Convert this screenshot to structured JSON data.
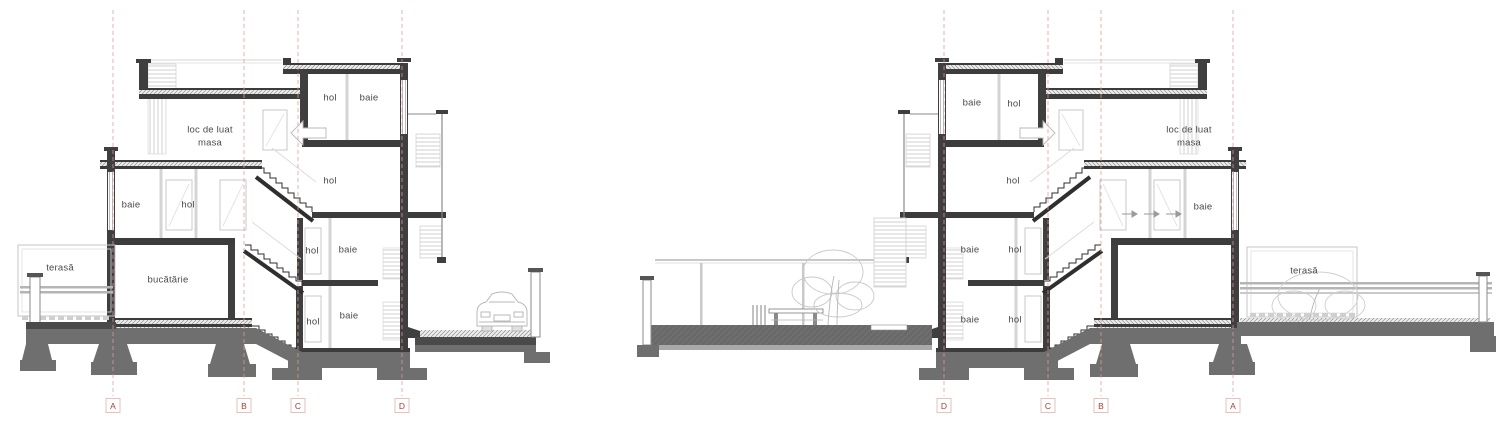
{
  "drawing": {
    "background": "#ffffff",
    "colors": {
      "wall_dark": "#3f3f3f",
      "foundation_gray": "#6f6f6f",
      "light_gray_line": "#c9c9c9",
      "label_text": "#4a4a4a",
      "grid_marker_red": "#b03a2e",
      "grid_line_red": "#dc9b94"
    },
    "icons": [
      "car-icon",
      "tree-icon",
      "bench-icon",
      "shrub-icon",
      "stair-arrow-icon"
    ],
    "sections": [
      {
        "name": "left-section",
        "room_labels": [
          "hol",
          "baie",
          "loc de luat masa",
          "hol",
          "baie",
          "hol",
          "hol",
          "baie",
          "terasă",
          "bucătărie",
          "hol",
          "baie"
        ],
        "grid_markers": [
          "A",
          "B",
          "C",
          "D"
        ]
      },
      {
        "name": "right-section",
        "room_labels": [
          "baie",
          "hol",
          "loc de luat masa",
          "hol",
          "baie",
          "baie",
          "hol",
          "baie",
          "hol",
          "terasă"
        ],
        "grid_markers": [
          "D",
          "C",
          "B",
          "A"
        ]
      }
    ]
  }
}
